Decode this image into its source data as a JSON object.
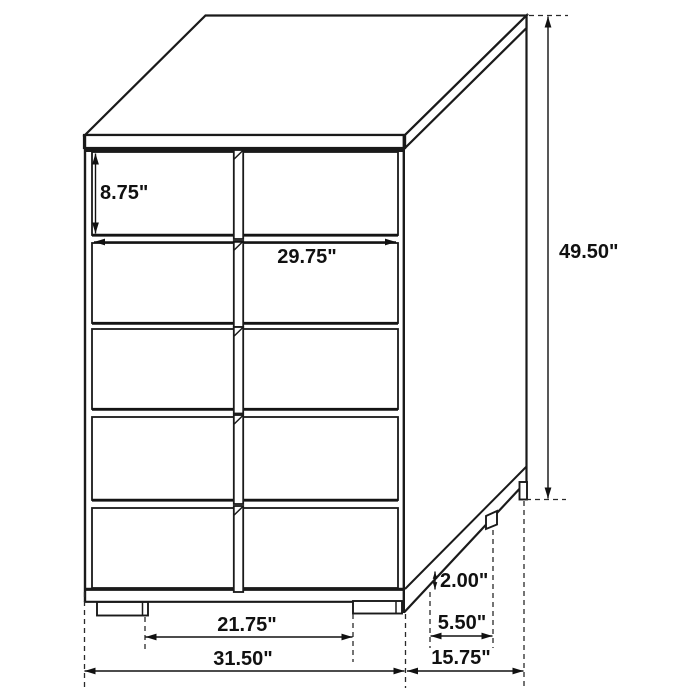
{
  "diagram": {
    "subject": "five-drawer chest dimension drawing",
    "unit": "inches",
    "drawer_count": 5
  },
  "labels": {
    "drawer_height": "8.75\"",
    "drawer_width": "29.75\"",
    "overall_height": "49.50\"",
    "leg_height": "2.00\"",
    "side_leg_gap": "5.50\"",
    "front_leg_span": "21.75\"",
    "overall_width": "31.50\"",
    "overall_depth": "15.75\""
  },
  "colors": {
    "background": "#ffffff",
    "line": "#1a1a1a"
  }
}
